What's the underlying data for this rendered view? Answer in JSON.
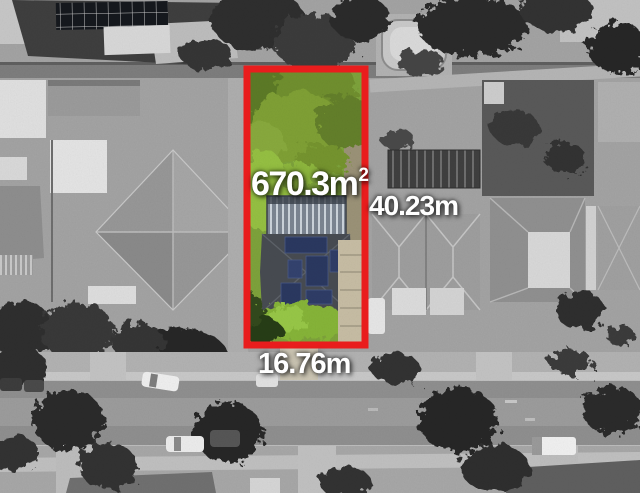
{
  "scene": {
    "description": "Black-and-white aerial photograph of a suburban block; the subject lot is shown in colour, outlined in red, with area and boundary dimensions overlaid."
  },
  "lot": {
    "area_value": "670.3m",
    "area_superscript": "2",
    "side_length": "40.23m",
    "frontage": "16.76m"
  },
  "colors": {
    "boundary_red": "#e91d1d",
    "label_text": "#ffffff",
    "lot_grass": "#7da23b",
    "lot_canopy": "#6f8f2e",
    "lawn_bright": "#8fbe40",
    "solar_panel_blue": "#2a3860",
    "surroundings_gray": "#9a9a9a"
  }
}
